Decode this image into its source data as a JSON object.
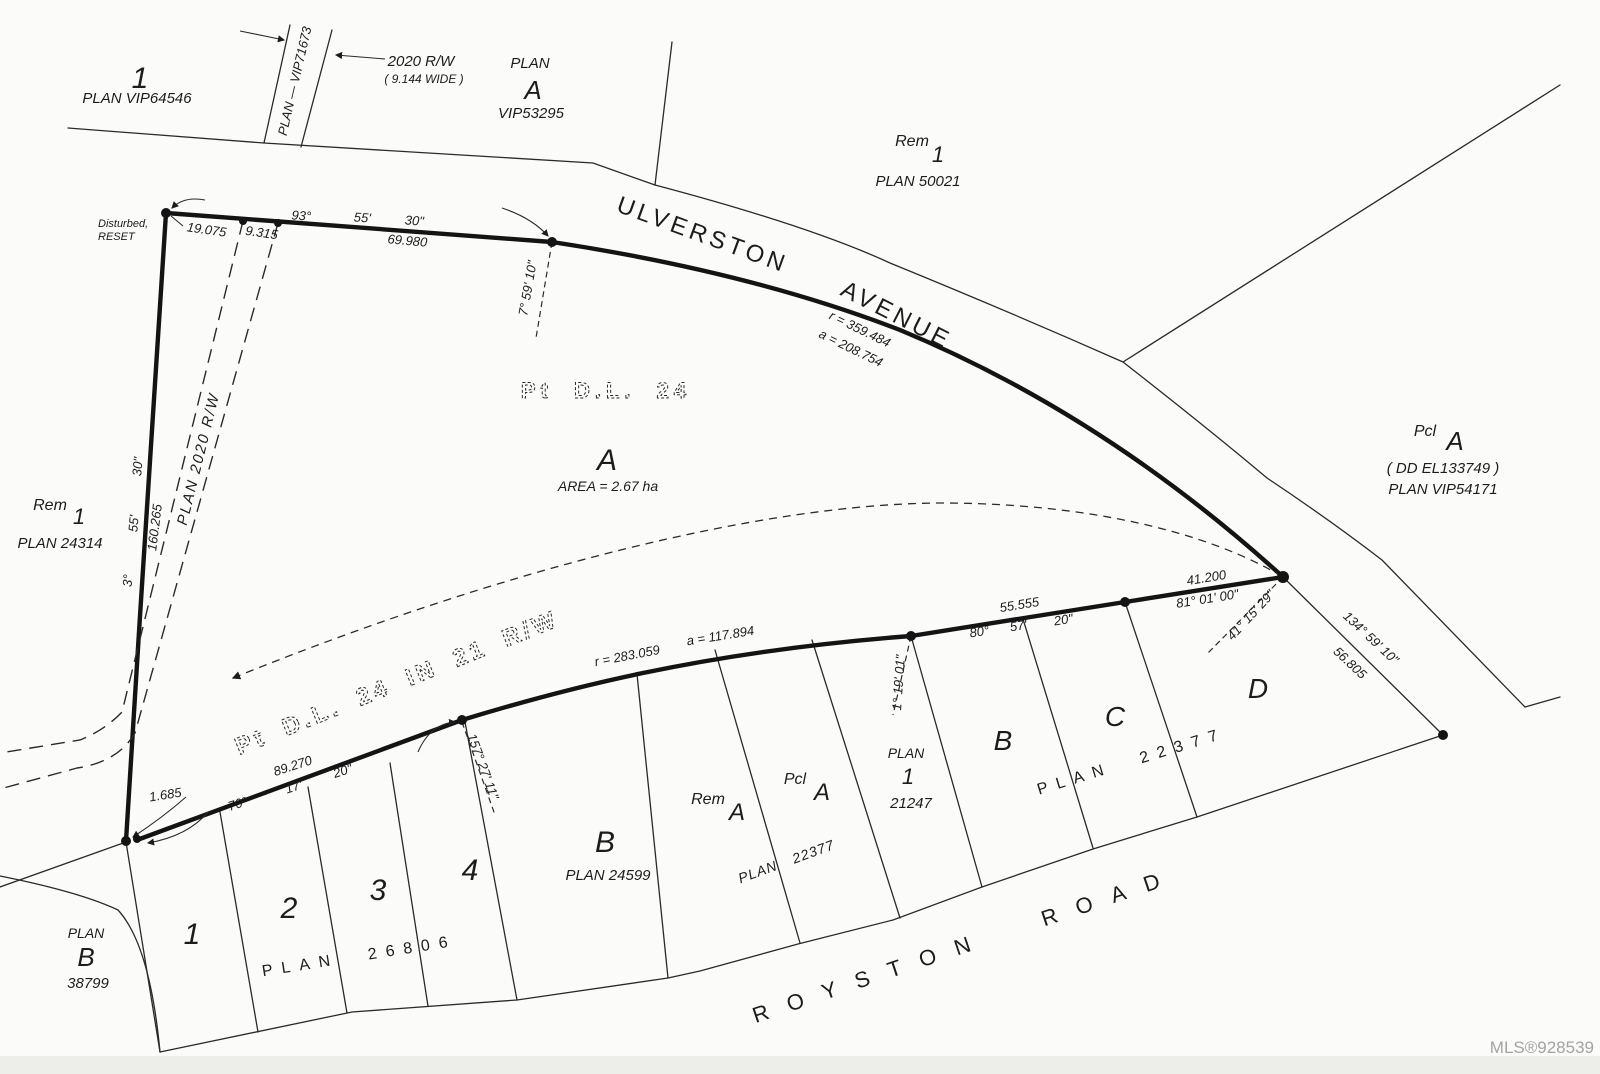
{
  "colors": {
    "ink": "#1c1c1c",
    "paper": "#fbfbf9",
    "watermark": "#a3a3a1"
  },
  "watermark": "MLS®928539",
  "roads": {
    "ulverston_word1": "ULVERSTON",
    "ulverston_word2": "AVENUE",
    "royston": "ROYSTON ROAD"
  },
  "parcels": {
    "vip64546": {
      "lot": "1",
      "plan": "PLAN  VIP64546"
    },
    "vip71673": "PLAN  —  VIP71673",
    "rw2020_top": {
      "l1": "2020  R/W",
      "l2": "( 9.144  WIDE )"
    },
    "vip53295": {
      "l1": "PLAN",
      "lot": "A",
      "plan": "VIP53295"
    },
    "rem1_50021": {
      "rem": "Rem",
      "lot": "1",
      "plan": "PLAN  50021"
    },
    "rem1_24314": {
      "rem": "Rem",
      "lot": "1",
      "plan": "PLAN  24314"
    },
    "pcl_a_54171": {
      "pcl": "Pcl",
      "lot": "A",
      "dd": "( DD  EL133749 )",
      "plan": "PLAN  VIP54171"
    },
    "subject": {
      "pt": "Pt  D.L.  24",
      "lot": "A",
      "area": "AREA  =  2.67  ha"
    },
    "rw21": "Pt  D.L.  24  IN  21  R/W",
    "plan2020rw": "PLAN  2020  R/W",
    "plan_b_38799": {
      "l1": "PLAN",
      "lot": "B",
      "plan": "38799"
    },
    "lots_26806": {
      "n1": "1",
      "n2": "2",
      "n3": "3",
      "n4": "4",
      "plan": "PLAN 26806"
    },
    "b_24599": {
      "lot": "B",
      "plan": "PLAN  24599"
    },
    "rem_a": {
      "rem": "Rem",
      "lot": "A"
    },
    "pcl_a_22377": {
      "pcl": "Pcl",
      "lot": "A"
    },
    "plan22377_small": "PLAN  22377",
    "lot1_21247": {
      "l1": "PLAN",
      "lot": "1",
      "plan": "21247"
    },
    "bcd": {
      "b": "B",
      "c": "C",
      "d": "D",
      "plan": "PLAN 22377"
    }
  },
  "dims": {
    "top": {
      "b1": "93°",
      "b2": "55'",
      "b3": "30\"",
      "d": "69.980",
      "d1": "19.075",
      "d2": "9.315"
    },
    "west": {
      "b1": "3°",
      "b2": "55'",
      "b3": "30\"",
      "d": "160.265"
    },
    "sw": {
      "d": "89.270",
      "b1": "70°",
      "b2": "17'",
      "b3": "20\"",
      "tie": "1.685"
    },
    "curve1": {
      "r": "r = 359.484",
      "a": "a = 208.754"
    },
    "curve2": {
      "r": "r = 283.059",
      "a": "a = 117.894"
    },
    "mid": {
      "d": "55.555",
      "b1": "80°",
      "b2": "57'",
      "b3": "20\""
    },
    "east": {
      "d": "41.200",
      "b": "81° 01' 00\""
    },
    "se": {
      "b": "134°  59'  10\"",
      "d": "56.805"
    },
    "leader1": "7° 59' 10\"",
    "leader2": "157° 27' 11\"",
    "leader3": "1° 19' 01\"",
    "leader4": "41° 15' 29\""
  },
  "notes": {
    "disturbed1": "Disturbed,",
    "disturbed2": "RESET"
  }
}
